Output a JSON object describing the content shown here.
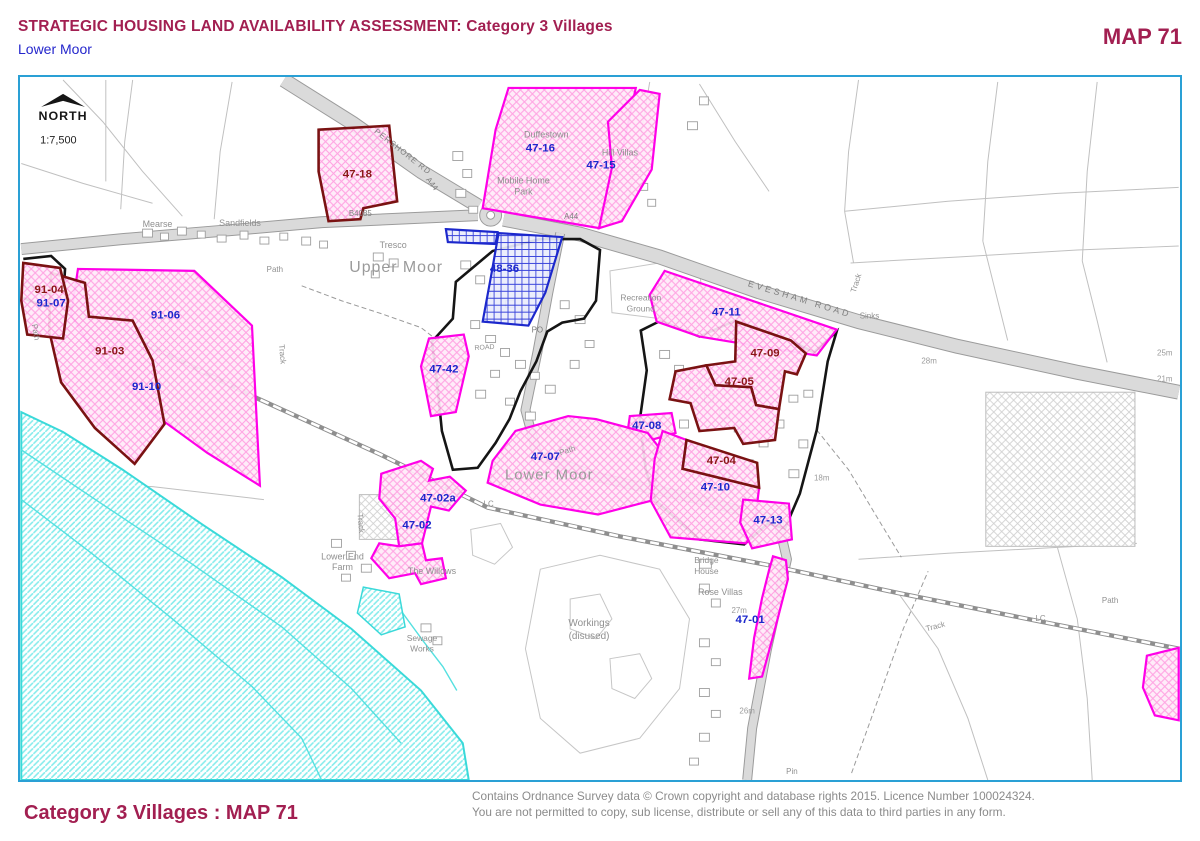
{
  "header": {
    "title": "STRATEGIC HOUSING LAND AVAILABILITY ASSESSMENT: Category 3 Villages",
    "subtitle": "Lower Moor",
    "map_number": "MAP 71"
  },
  "footer": {
    "left": "Category 3 Villages : MAP 71",
    "copyright_line1": "Contains Ordnance Survey data © Crown copyright and database rights 2015. Licence Number 100024324.",
    "copyright_line2": "You are not permitted to copy, sub license, distribute or sell any of this data to third parties in any form."
  },
  "north": {
    "label": "NORTH",
    "scale": "1:7,500",
    "arrow": "38,105 60,92 82,105 60,99"
  },
  "colors": {
    "header": "#a21f51",
    "subtitle": "#2426cc",
    "frame": "#2aa0d5",
    "copyright": "#8b8b8b",
    "magenta": "#ff00e8",
    "maroon": "#7a1212",
    "blue": "#1c28cc",
    "darkred": "#8b1717",
    "pink_hatch": "#ff9ce0",
    "blue_hatch": "#2a35d8",
    "cyan": "#3ad9d9",
    "boundary_black": "#151515"
  },
  "map": {
    "parcels": [
      {
        "id": "47-16",
        "pts": "508,86 636,86 620,160 599,227 482,207 495,128",
        "stroke": "magenta",
        "fill": "pink",
        "label_color": "blue",
        "lx": 540,
        "ly": 150
      },
      {
        "id": "47-15",
        "pts": "608,120 640,88 660,92 652,168 622,220 599,227 612,166",
        "stroke": "magenta",
        "fill": "pink",
        "label_color": "blue",
        "lx": 601,
        "ly": 167
      },
      {
        "id": "47-18",
        "pts": "317,128 388,124 396,200 362,207 359,218 327,220 317,170",
        "stroke": "maroon",
        "fill": "pink",
        "label_color": "darkred",
        "lx": 356,
        "ly": 176
      },
      {
        "id": "91-06",
        "pts": "75,268 192,270 250,325 258,486 205,453 150,413 90,350 68,314",
        "stroke": "magenta",
        "fill": "pink",
        "label_color": "blue",
        "lx": 163,
        "ly": 318
      },
      {
        "id": "91-03",
        "pts": "48,272 82,282 86,316 130,320 150,360 162,424 132,464 92,428 58,382 46,330",
        "stroke": "maroon",
        "fill": "pink",
        "label_color": "darkred",
        "lx": 107,
        "ly": 354
      },
      {
        "id": "91-04",
        "pts": "20,262 57,267 65,300 60,338 24,334 18,300",
        "stroke": "maroon",
        "fill": "pink",
        "label_color": "darkred",
        "lx": 46,
        "ly": 292
      },
      {
        "id": "",
        "pts": "445,228 497,231 495,243 447,241",
        "stroke": "blue",
        "fill": "blue",
        "label_color": "blue",
        "lx": 0,
        "ly": 0
      },
      {
        "id": "48-36",
        "pts": "498,232 562,236 545,292 528,325 482,321 491,272",
        "stroke": "blue",
        "fill": "blue",
        "label_color": "blue",
        "lx": 504,
        "ly": 271
      },
      {
        "id": "47-42",
        "pts": "428,338 463,334 468,356 455,412 430,416 420,366",
        "stroke": "magenta",
        "fill": "pink",
        "label_color": "blue",
        "lx": 443,
        "ly": 372
      },
      {
        "id": "47-11",
        "pts": "665,270 838,329 818,355 748,344 700,336 657,321 650,294",
        "stroke": "magenta",
        "fill": "pink",
        "label_color": "blue",
        "lx": 727,
        "ly": 315
      },
      {
        "id": "47-09",
        "pts": "737,321 792,340 807,353 798,374 786,371 780,409 757,405 752,387 716,385 707,365 736,361",
        "stroke": "maroon",
        "fill": "pink",
        "label_color": "darkred",
        "lx": 766,
        "ly": 356
      },
      {
        "id": "47-05",
        "pts": "707,365 716,385 752,387 757,405 780,409 776,440 744,444 735,428 700,431 691,403 670,399 676,371",
        "stroke": "maroon",
        "fill": "pink",
        "label_color": "darkred",
        "lx": 740,
        "ly": 385
      },
      {
        "id": "47-08",
        "pts": "630,416 672,413 676,433 648,441 628,430",
        "stroke": "magenta",
        "fill": "pink",
        "label_color": "blue",
        "lx": 647,
        "ly": 429
      },
      {
        "id": "47-07",
        "pts": "515,431 568,416 596,419 648,433 662,451 652,501 598,515 540,505 487,483 492,461",
        "stroke": "magenta",
        "fill": "pink",
        "label_color": "blue",
        "lx": 545,
        "ly": 460
      },
      {
        "id": "47-10",
        "pts": "663,431 687,440 683,469 760,488 755,530 747,544 671,538 651,501 655,459",
        "stroke": "magenta",
        "fill": "pink",
        "label_color": "blue",
        "lx": 716,
        "ly": 491
      },
      {
        "id": "47-04",
        "pts": "687,440 758,463 760,488 683,469",
        "stroke": "maroon",
        "fill": "pink",
        "label_color": "darkred",
        "lx": 722,
        "ly": 464
      },
      {
        "id": "47-13",
        "pts": "744,500 790,504 793,540 753,549 741,523",
        "stroke": "magenta",
        "fill": "pink",
        "label_color": "blue",
        "lx": 769,
        "ly": 524
      },
      {
        "id": "47-02a",
        "pts": "380,474 420,461 432,469 428,481 449,477 465,491 448,511 430,507 421,544 398,547 394,519 378,499",
        "stroke": "magenta",
        "fill": "pink",
        "label_color": "blue",
        "lx": 437,
        "ly": 502
      },
      {
        "id": "47-02",
        "pts": "398,547 421,544 425,561 441,559 445,579 420,585 414,574 388,579 370,559 378,544",
        "stroke": "magenta",
        "fill": "pink",
        "label_color": "blue",
        "lx": 416,
        "ly": 529
      },
      {
        "id": "47-01",
        "pts": "774,557 787,561 789,580 776,630 763,678 750,680 755,639 763,599 770,571",
        "stroke": "magenta",
        "fill": "pink",
        "label_color": "blue",
        "lx": 751,
        "ly": 624
      },
      {
        "id": "",
        "pts": "1150,657 1182,649 1182,722 1158,717 1146,689",
        "stroke": "magenta",
        "fill": "pink",
        "label_color": "blue",
        "lx": 0,
        "ly": 0
      }
    ],
    "extra_site_labels": [
      {
        "t": "91-07",
        "x": 48,
        "y": 306,
        "c": "blue"
      },
      {
        "t": "91-10",
        "x": 144,
        "y": 390,
        "c": "blue"
      }
    ],
    "boundaries": [
      {
        "pts": "455,281 492,250 540,238 580,238 600,249 596,300 584,318 562,322 547,331 536,361 520,391 509,419 495,443 477,468 452,470 441,431 436,381 431,341 452,318",
        "closed": true
      },
      {
        "pts": "641,330 661,320 700,336 736,320 792,340 815,352 838,331 829,361 818,430 801,494 786,529 769,524 745,545 700,540 656,501 646,470 640,420 647,370",
        "closed": true
      },
      {
        "pts": "20,258 48,255 62,268 60,300 38,305 20,297",
        "closed": false
      }
    ],
    "roads": [
      {
        "pts": "282,78 352,122 420,170 478,205",
        "w": 13
      },
      {
        "pts": "18,248 120,238 240,228 320,221 477,214",
        "w": 10
      },
      {
        "pts": "503,218 580,233 660,256 760,291 860,321 960,346 1080,372 1182,392",
        "w": 13
      },
      {
        "pts": "560,232 548,292 537,352 525,410 537,455 600,478 700,500 779,521 788,560 768,650 753,730 748,782",
        "w": 8
      }
    ],
    "roundabout": {
      "cx": 490,
      "cy": 214,
      "r": 11
    },
    "railway": "20,282 130,337 255,398 380,455 487,508 620,537 770,566 900,594 1040,622 1182,650",
    "field_lines": [
      "103,78 103,180",
      "130,78 122,140 118,208",
      "230,80 218,150 212,218",
      "60,78 100,120 140,170 180,215",
      "18,162 80,182 150,202",
      "650,80 640,140 628,200",
      "700,82 736,140 770,190",
      "860,78 850,150 846,210 855,262",
      "1000,80 990,160 985,240",
      "1100,80 1090,170 1085,260",
      "846,210 950,200 1060,192 1182,186",
      "852,262 960,256 1080,249 1182,245",
      "985,240 1000,300 1010,340",
      "1085,260 1100,320 1110,362",
      "18,481 150,487 262,500",
      "860,560 950,554 1060,548 1140,544",
      "900,594 940,650 970,720 990,782",
      "1060,548 1080,620 1090,700 1095,782",
      "18,520 120,610 220,700 300,782",
      "18,600 100,680 180,760",
      "60,440 160,520 260,600 340,680 400,742",
      "120,470 230,560 330,650 400,720"
    ],
    "outlines": [
      "540,570 600,556 660,570 690,620 680,690 640,740 580,755 540,720 525,650",
      "570,600 600,595 612,620 596,640 570,630",
      "610,660 640,655 652,680 635,700 612,690",
      "470,530 500,524 512,548 494,565 472,556",
      "610,270 660,262 700,270 705,310 660,318 612,312"
    ],
    "grey_areas": [
      [
        988,
        392,
        150,
        155
      ],
      [
        358,
        495,
        48,
        45
      ]
    ],
    "dashed": [
      "300,285 340,300 380,313 420,327 434,338",
      "853,775 880,700 905,630 930,572",
      "818,430 850,470 880,520 903,558"
    ],
    "water": {
      "area": "18,412 60,432 120,470 200,525 280,578 350,630 420,692 462,745 468,782 18,782",
      "patch": "362,588 398,595 404,628 380,636 356,614",
      "lines": [
        "18,450 100,505 190,565 280,628 350,690 400,745",
        "18,500 90,555 170,620 250,688 300,740 320,782",
        "370,595 400,612 422,642 442,668 456,692"
      ]
    },
    "buildings": [
      [
        140,
        228,
        10,
        8
      ],
      [
        158,
        232,
        8,
        7
      ],
      [
        175,
        226,
        9,
        8
      ],
      [
        195,
        230,
        8,
        7
      ],
      [
        215,
        234,
        9,
        7
      ],
      [
        238,
        230,
        8,
        8
      ],
      [
        258,
        236,
        9,
        7
      ],
      [
        278,
        232,
        8,
        7
      ],
      [
        300,
        236,
        9,
        8
      ],
      [
        318,
        240,
        8,
        7
      ],
      [
        372,
        252,
        10,
        8
      ],
      [
        388,
        258,
        9,
        8
      ],
      [
        370,
        270,
        8,
        7
      ],
      [
        452,
        150,
        10,
        9
      ],
      [
        462,
        168,
        9,
        8
      ],
      [
        455,
        188,
        10,
        8
      ],
      [
        468,
        205,
        9,
        7
      ],
      [
        610,
        135,
        9,
        7
      ],
      [
        622,
        150,
        8,
        7
      ],
      [
        632,
        166,
        9,
        7
      ],
      [
        640,
        182,
        8,
        7
      ],
      [
        648,
        198,
        8,
        7
      ],
      [
        688,
        120,
        10,
        8
      ],
      [
        700,
        95,
        9,
        8
      ],
      [
        460,
        260,
        10,
        8
      ],
      [
        475,
        275,
        9,
        8
      ],
      [
        490,
        290,
        10,
        8
      ],
      [
        505,
        300,
        9,
        7
      ],
      [
        520,
        310,
        10,
        8
      ],
      [
        470,
        320,
        9,
        8
      ],
      [
        485,
        335,
        10,
        7
      ],
      [
        500,
        348,
        9,
        8
      ],
      [
        515,
        360,
        10,
        8
      ],
      [
        530,
        372,
        9,
        7
      ],
      [
        545,
        385,
        10,
        8
      ],
      [
        490,
        370,
        9,
        7
      ],
      [
        475,
        390,
        10,
        8
      ],
      [
        505,
        398,
        9,
        7
      ],
      [
        525,
        412,
        10,
        8
      ],
      [
        545,
        425,
        9,
        7
      ],
      [
        560,
        440,
        10,
        8
      ],
      [
        580,
        430,
        9,
        7
      ],
      [
        560,
        300,
        9,
        8
      ],
      [
        575,
        315,
        10,
        8
      ],
      [
        585,
        340,
        9,
        7
      ],
      [
        570,
        360,
        9,
        8
      ],
      [
        660,
        350,
        10,
        8
      ],
      [
        675,
        365,
        9,
        8
      ],
      [
        690,
        380,
        10,
        8
      ],
      [
        705,
        395,
        9,
        7
      ],
      [
        720,
        410,
        10,
        8
      ],
      [
        735,
        425,
        9,
        7
      ],
      [
        680,
        420,
        9,
        8
      ],
      [
        665,
        440,
        10,
        8
      ],
      [
        700,
        455,
        9,
        7
      ],
      [
        720,
        470,
        10,
        8
      ],
      [
        745,
        460,
        9,
        8
      ],
      [
        760,
        440,
        9,
        7
      ],
      [
        775,
        420,
        10,
        8
      ],
      [
        790,
        395,
        9,
        7
      ],
      [
        775,
        370,
        9,
        8
      ],
      [
        805,
        390,
        9,
        7
      ],
      [
        800,
        440,
        9,
        8
      ],
      [
        790,
        470,
        10,
        8
      ],
      [
        700,
        560,
        12,
        9
      ],
      [
        700,
        585,
        10,
        8
      ],
      [
        712,
        600,
        9,
        8
      ],
      [
        700,
        640,
        10,
        8
      ],
      [
        712,
        660,
        9,
        7
      ],
      [
        700,
        690,
        10,
        8
      ],
      [
        712,
        712,
        9,
        7
      ],
      [
        700,
        735,
        10,
        8
      ],
      [
        690,
        760,
        9,
        7
      ],
      [
        330,
        540,
        10,
        8
      ],
      [
        345,
        552,
        9,
        8
      ],
      [
        360,
        565,
        10,
        8
      ],
      [
        340,
        575,
        9,
        7
      ],
      [
        420,
        625,
        10,
        8
      ],
      [
        432,
        638,
        9,
        8
      ]
    ],
    "labels": {
      "places": [
        {
          "t": "Upper Moor",
          "x": 395,
          "y": 271,
          "s": 16,
          "c": "#9a9a9a",
          "ls": 1
        },
        {
          "t": "Lower Moor",
          "x": 549,
          "y": 480,
          "s": 15,
          "c": "#9a9a9a",
          "ls": 1
        },
        {
          "t": "Mearse",
          "x": 155,
          "y": 226
        },
        {
          "t": "Sandfields",
          "x": 238,
          "y": 225
        },
        {
          "t": "Tresco",
          "x": 392,
          "y": 247
        },
        {
          "t": "Duffestown",
          "x": 546,
          "y": 136
        },
        {
          "t": "Mobile Home",
          "x": 523,
          "y": 182
        },
        {
          "t": "Park",
          "x": 523,
          "y": 193
        },
        {
          "t": "Hill Villas",
          "x": 620,
          "y": 154
        },
        {
          "t": "Recreation",
          "x": 641,
          "y": 300,
          "s": 8.5
        },
        {
          "t": "Ground",
          "x": 641,
          "y": 311,
          "s": 8.5
        },
        {
          "t": "PO",
          "x": 537,
          "y": 332,
          "s": 8,
          "c": "#7a7a7a"
        },
        {
          "t": "ROAD",
          "x": 484,
          "y": 349,
          "s": 7,
          "r": -4
        },
        {
          "t": "Lower End",
          "x": 341,
          "y": 560
        },
        {
          "t": "Farm",
          "x": 341,
          "y": 571
        },
        {
          "t": "The Willows",
          "x": 431,
          "y": 575
        },
        {
          "t": "Sewage",
          "x": 421,
          "y": 642,
          "s": 8.5
        },
        {
          "t": "Works",
          "x": 421,
          "y": 653,
          "s": 8.5
        },
        {
          "t": "Workings",
          "x": 589,
          "y": 627,
          "s": 10
        },
        {
          "t": "(disused)",
          "x": 589,
          "y": 640,
          "s": 10
        },
        {
          "t": "Bridge",
          "x": 707,
          "y": 564,
          "s": 8.5
        },
        {
          "t": "House",
          "x": 707,
          "y": 575,
          "s": 8.5
        },
        {
          "t": "Rose Villas",
          "x": 721,
          "y": 596
        },
        {
          "t": "Sinks",
          "x": 871,
          "y": 318,
          "s": 8
        },
        {
          "t": "Pin",
          "x": 793,
          "y": 776,
          "s": 8
        },
        {
          "t": "Path",
          "x": 273,
          "y": 271,
          "s": 8
        },
        {
          "t": "Path",
          "x": 568,
          "y": 453,
          "s": 8,
          "r": -18
        },
        {
          "t": "Path",
          "x": 1113,
          "y": 604,
          "s": 8
        },
        {
          "t": "Path",
          "x": 30,
          "y": 332,
          "s": 8,
          "r": 80
        },
        {
          "t": "Track",
          "x": 860,
          "y": 283,
          "s": 8,
          "r": -72
        },
        {
          "t": "Track",
          "x": 357,
          "y": 524,
          "s": 8,
          "r": 85
        },
        {
          "t": "Track",
          "x": 938,
          "y": 630,
          "s": 8,
          "r": -15
        },
        {
          "t": "Track",
          "x": 278,
          "y": 354,
          "s": 8,
          "r": 85
        },
        {
          "t": "LC",
          "x": 488,
          "y": 507,
          "s": 8
        },
        {
          "t": "LC",
          "x": 1043,
          "y": 622,
          "s": 8
        }
      ],
      "roads": [
        {
          "t": "B4085",
          "x": 359,
          "y": 215,
          "s": 8
        },
        {
          "t": "A44",
          "x": 571,
          "y": 218,
          "s": 8
        },
        {
          "t": "A44",
          "x": 429,
          "y": 184,
          "s": 8,
          "r": 52
        },
        {
          "t": "PERSHORE RD",
          "x": 400,
          "y": 152,
          "s": 8,
          "r": 38,
          "ls": 1
        },
        {
          "t": "EVESHAM ROAD",
          "x": 800,
          "y": 301,
          "s": 9,
          "r": 17,
          "ls": 3
        }
      ],
      "spots": [
        {
          "t": "18m",
          "x": 823,
          "y": 481
        },
        {
          "t": "28m",
          "x": 931,
          "y": 363
        },
        {
          "t": "27m",
          "x": 740,
          "y": 614
        },
        {
          "t": "26m",
          "x": 748,
          "y": 715
        },
        {
          "t": "25m",
          "x": 1168,
          "y": 355
        },
        {
          "t": "21m",
          "x": 1168,
          "y": 381
        }
      ]
    }
  }
}
